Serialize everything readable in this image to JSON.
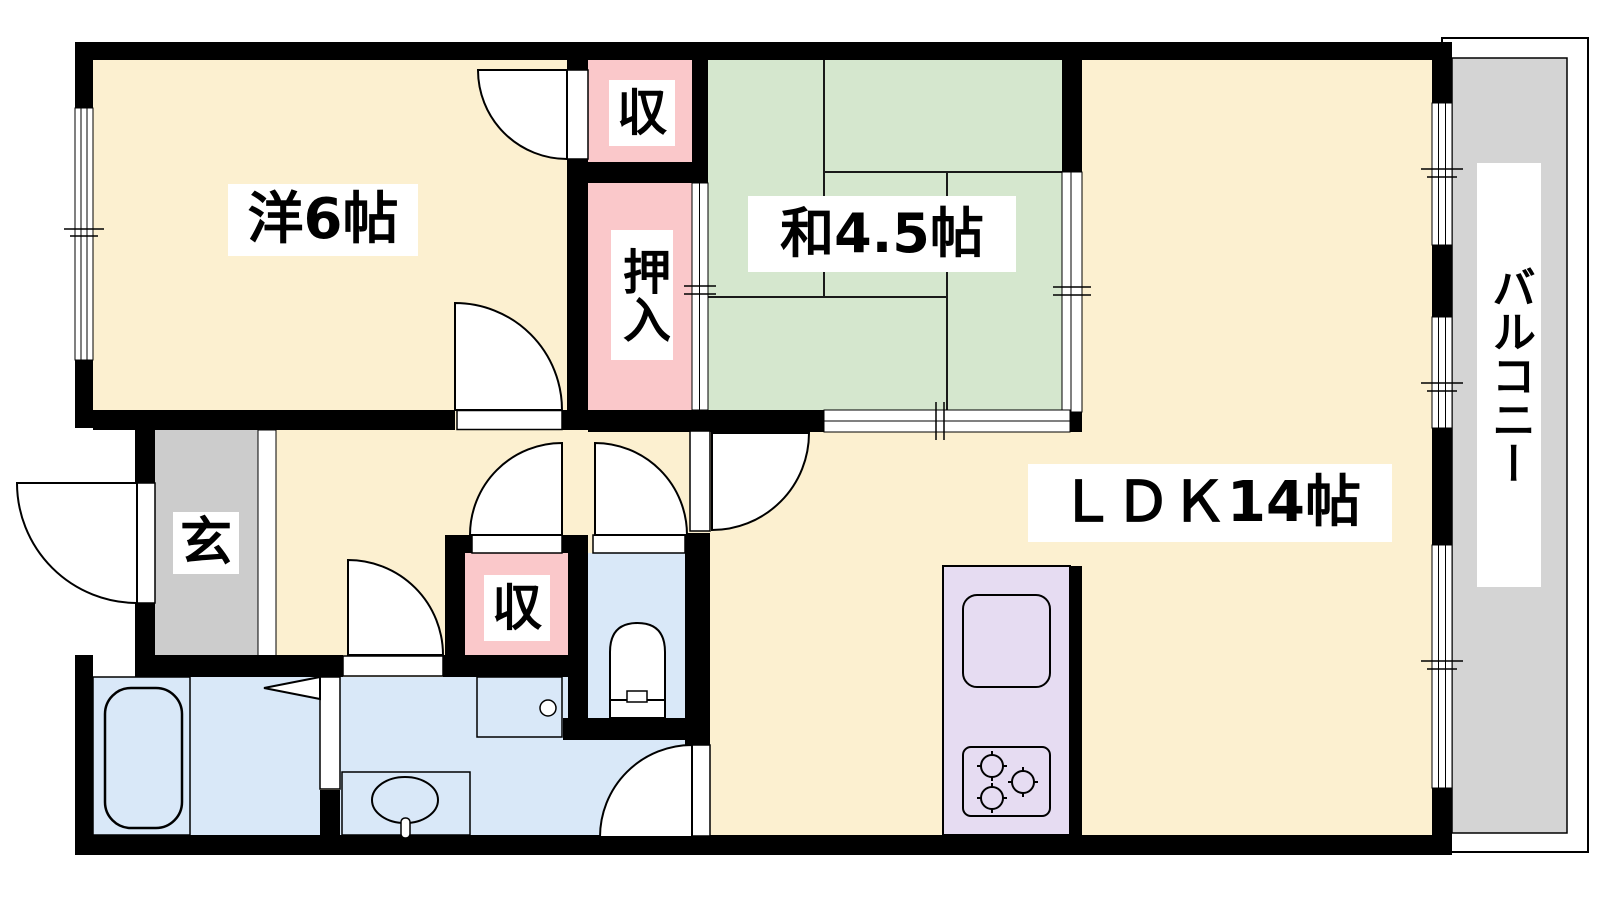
{
  "floorplan": {
    "type": "apartment-floor-plan",
    "rooms": {
      "western_room": {
        "label": "洋6帖"
      },
      "japanese_room": {
        "label": "和4.5帖"
      },
      "ldk": {
        "label": "ＬＤＫ14帖"
      },
      "balcony": {
        "label": "バルコニー"
      },
      "entrance": {
        "label": "玄"
      },
      "closet_upper": {
        "label": "収"
      },
      "oshiire": {
        "label": "押入"
      },
      "closet_hall": {
        "label": "収"
      }
    },
    "colors": {
      "floor_cream": "#FCF0D0",
      "tatami_green": "#D5E7CE",
      "closet_pink": "#FAC8CA",
      "wet_area_blue": "#D9E8F8",
      "kitchen_lavender": "#E6DCF2",
      "entrance_gray": "#CCCCCC",
      "balcony_gray": "#D4D4D4",
      "wall_black": "#000000"
    }
  }
}
